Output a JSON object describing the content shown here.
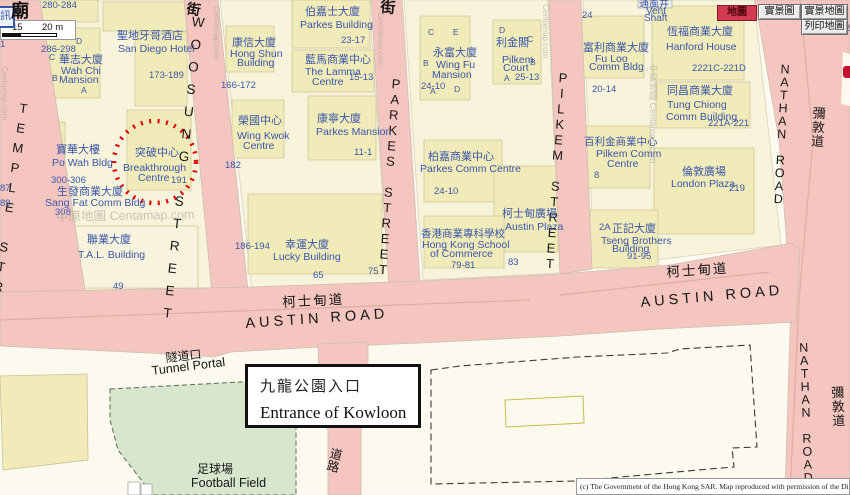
{
  "colors": {
    "road_pink": "#F4C6BF",
    "block_beige": "#F8F4DC",
    "footprint_yellow": "#F1EBBA",
    "park_green": "#D8E6CE",
    "label_blue": "#3A57A8",
    "street_black": "#161616",
    "circle_red": "#E10000",
    "selected_button_red": "#D23B52",
    "mtr_red": "#C8102E"
  },
  "toolbar": {
    "map": "地圖",
    "real_view": "實景圖",
    "real_view_map": "實景地圖",
    "print_map": "列印地圖"
  },
  "scalebar": {
    "mid_label": "15",
    "end_label": "20 m"
  },
  "corner": {
    "info_icon": "訊",
    "temple_char": "廟"
  },
  "annotation_box": {
    "title_zh": "九龍公園入口",
    "title_en": "Entrance of Kowloon"
  },
  "copyright": "(c) The Government of the Hong Kong SAR. Map reproduced with permission of the Di",
  "map": {
    "labels": [
      {
        "t": "TEMPLE STREET",
        "x": 18,
        "y": 100,
        "fs": 13,
        "k": "black",
        "v": true,
        "rot": 8,
        "ls": 5,
        "n": "street-label-temple"
      },
      {
        "t": "WOOSUNG STREET",
        "x": 192,
        "y": 14,
        "fs": 13.5,
        "k": "black",
        "v": true,
        "rot": 6,
        "ls": 7.5,
        "n": "street-label-woosung"
      },
      {
        "t": "PARKES STREET",
        "x": 390,
        "y": 76,
        "fs": 13,
        "k": "black",
        "v": true,
        "rot": 4,
        "ls": 0.5,
        "n": "street-label-parkes"
      },
      {
        "t": "PILKEM STREET",
        "x": 557,
        "y": 70,
        "fs": 13,
        "k": "black",
        "v": true,
        "rot": 4,
        "ls": 0.5,
        "n": "street-label-pilkem"
      },
      {
        "t": "NATHAN ROAD",
        "x": 779,
        "y": 62,
        "fs": 12.5,
        "k": "black",
        "v": true,
        "rot": 3,
        "ls": -1,
        "n": "street-label-nathan-north"
      },
      {
        "t": "NATHAN ROAD",
        "x": 797,
        "y": 341,
        "fs": 12.5,
        "k": "black",
        "v": true,
        "rot": -2,
        "ls": -1,
        "n": "street-label-nathan-south"
      },
      {
        "t": "彌敦道",
        "x": 812,
        "y": 106,
        "fs": 13,
        "k": "black",
        "v": true,
        "rot": 3,
        "ls": 1,
        "n": "street-label-nathan-zh-north"
      },
      {
        "t": "彌敦道",
        "x": 830,
        "y": 386,
        "fs": 13,
        "k": "black",
        "v": true,
        "rot": -2,
        "ls": 1,
        "n": "street-label-nathan-zh-south"
      },
      {
        "t": "AUSTIN ROAD",
        "x": 245,
        "y": 317,
        "fs": 14.5,
        "k": "black",
        "rot": -4,
        "ls": 4,
        "n": "street-label-austin-west"
      },
      {
        "t": "AUSTIN ROAD",
        "x": 640,
        "y": 296,
        "fs": 14.5,
        "k": "black",
        "rot": -5,
        "ls": 4,
        "n": "street-label-austin-east"
      },
      {
        "t": "柯士甸道",
        "x": 282,
        "y": 296,
        "fs": 13.5,
        "k": "black",
        "rot": -3,
        "ls": 2,
        "n": "street-label-austin-zh-west"
      },
      {
        "t": "柯士甸道",
        "x": 666,
        "y": 266,
        "fs": 13.5,
        "k": "black",
        "rot": -4,
        "ls": 2,
        "n": "street-label-austin-zh-east"
      },
      {
        "t": "道路",
        "x": 330,
        "y": 446,
        "fs": 12.5,
        "k": "black",
        "v": true,
        "rot": 14,
        "n": "street-label-road"
      },
      {
        "t": "街",
        "x": 188,
        "y": 1,
        "fs": 14,
        "k": "black",
        "rot": 10,
        "b": true,
        "n": "street-char"
      },
      {
        "t": "街",
        "x": 381,
        "y": 0,
        "fs": 15,
        "k": "black",
        "rot": 4,
        "b": true,
        "n": "street-char"
      },
      {
        "t": "隧道口",
        "x": 165,
        "y": 352,
        "fs": 12,
        "k": "black",
        "rot": -6,
        "n": "tunnel-portal-zh"
      },
      {
        "t": "Tunnel Portal",
        "x": 151,
        "y": 365,
        "fs": 12.5,
        "k": "black",
        "rot": -7,
        "n": "tunnel-portal-en"
      },
      {
        "t": "足球場",
        "x": 197,
        "y": 463,
        "fs": 12,
        "k": "black",
        "n": "football-field-zh"
      },
      {
        "t": "Football Field",
        "x": 191,
        "y": 477,
        "fs": 12.5,
        "k": "black",
        "n": "football-field-en"
      },
      {
        "t": "280-284",
        "x": 42,
        "y": 1,
        "fs": 9.5
      },
      {
        "t": "1",
        "x": 0,
        "y": 40,
        "fs": 9.5
      },
      {
        "t": "286-298",
        "x": 41,
        "y": 45,
        "fs": 9.5
      },
      {
        "t": "D",
        "x": 76,
        "y": 37,
        "fs": 8.5
      },
      {
        "t": "C",
        "x": 49,
        "y": 53,
        "fs": 8.5
      },
      {
        "t": "B",
        "x": 52,
        "y": 74,
        "fs": 8.5
      },
      {
        "t": "A",
        "x": 81,
        "y": 86,
        "fs": 8.5
      },
      {
        "t": "華志大廈",
        "x": 59,
        "y": 55,
        "fs": 11
      },
      {
        "t": "Wah Chi",
        "x": 61,
        "y": 66,
        "fs": 10.5
      },
      {
        "t": "Mansion",
        "x": 59,
        "y": 75,
        "fs": 10.5
      },
      {
        "t": "聖地牙哥酒店",
        "x": 117,
        "y": 31,
        "fs": 11
      },
      {
        "t": "San Diego Hotel",
        "x": 118,
        "y": 44,
        "fs": 10.5
      },
      {
        "t": "173-189",
        "x": 149,
        "y": 71,
        "fs": 9.5
      },
      {
        "t": "寶華大樓",
        "x": 56,
        "y": 145,
        "fs": 11
      },
      {
        "t": "Po Wah Bldg",
        "x": 52,
        "y": 158,
        "fs": 10.5
      },
      {
        "t": "300-306",
        "x": 51,
        "y": 176,
        "fs": 9.5
      },
      {
        "t": "生發商業大廈",
        "x": 57,
        "y": 187,
        "fs": 11
      },
      {
        "t": "Sang Fat Comm Bldg",
        "x": 45,
        "y": 198,
        "fs": 10.5
      },
      {
        "t": "308",
        "x": 55,
        "y": 208,
        "fs": 9.5
      },
      {
        "t": "87",
        "x": 0,
        "y": 184,
        "fs": 9.5
      },
      {
        "t": "89",
        "x": 0,
        "y": 199,
        "fs": 9.5
      },
      {
        "t": "突破中心",
        "x": 135,
        "y": 148,
        "fs": 11
      },
      {
        "t": "Breakthrough",
        "x": 123,
        "y": 163,
        "fs": 10.5
      },
      {
        "t": "Centre",
        "x": 138,
        "y": 173,
        "fs": 10.5
      },
      {
        "t": "191",
        "x": 171,
        "y": 176,
        "fs": 9.5
      },
      {
        "t": "聯業大廈",
        "x": 87,
        "y": 235,
        "fs": 11
      },
      {
        "t": "T.A.L. Building",
        "x": 78,
        "y": 250,
        "fs": 10.5
      },
      {
        "t": "49",
        "x": 113,
        "y": 282,
        "fs": 9.5
      },
      {
        "t": "康信大廈",
        "x": 232,
        "y": 38,
        "fs": 11
      },
      {
        "t": "Hong Shun",
        "x": 230,
        "y": 49,
        "fs": 10.5
      },
      {
        "t": "Building",
        "x": 237,
        "y": 58,
        "fs": 10.5
      },
      {
        "t": "166-172",
        "x": 221,
        "y": 81,
        "fs": 9.5
      },
      {
        "t": "伯嘉士大廈",
        "x": 305,
        "y": 7,
        "fs": 11
      },
      {
        "t": "Parkes Building",
        "x": 300,
        "y": 20,
        "fs": 10.5
      },
      {
        "t": "23-17",
        "x": 341,
        "y": 36,
        "fs": 9.5
      },
      {
        "t": "藍馬商業中心",
        "x": 305,
        "y": 55,
        "fs": 11
      },
      {
        "t": "The Lamma",
        "x": 305,
        "y": 67,
        "fs": 10.5
      },
      {
        "t": "Centre",
        "x": 312,
        "y": 77,
        "fs": 10.5
      },
      {
        "t": "15-13",
        "x": 349,
        "y": 73,
        "fs": 9.5
      },
      {
        "t": "榮國中心",
        "x": 238,
        "y": 116,
        "fs": 11
      },
      {
        "t": "Wing Kwok",
        "x": 237,
        "y": 131,
        "fs": 10.5
      },
      {
        "t": "Centre",
        "x": 243,
        "y": 141,
        "fs": 10.5
      },
      {
        "t": "182",
        "x": 225,
        "y": 161,
        "fs": 9.5
      },
      {
        "t": "康寧大廈",
        "x": 317,
        "y": 114,
        "fs": 11
      },
      {
        "t": "Parkes Mansion",
        "x": 316,
        "y": 127,
        "fs": 10.5
      },
      {
        "t": "11-1",
        "x": 354,
        "y": 148,
        "fs": 9.5
      },
      {
        "t": "186-194",
        "x": 235,
        "y": 242,
        "fs": 9.5
      },
      {
        "t": "幸運大廈",
        "x": 285,
        "y": 240,
        "fs": 11
      },
      {
        "t": "Lucky Building",
        "x": 273,
        "y": 252,
        "fs": 10.5
      },
      {
        "t": "65",
        "x": 313,
        "y": 271,
        "fs": 9.5
      },
      {
        "t": "75",
        "x": 368,
        "y": 267,
        "fs": 9.5
      },
      {
        "t": "C",
        "x": 428,
        "y": 28,
        "fs": 8.5
      },
      {
        "t": "E",
        "x": 453,
        "y": 28,
        "fs": 8.5
      },
      {
        "t": "B",
        "x": 423,
        "y": 59,
        "fs": 8.5
      },
      {
        "t": "A",
        "x": 430,
        "y": 87,
        "fs": 8.5
      },
      {
        "t": "D",
        "x": 454,
        "y": 85,
        "fs": 8.5
      },
      {
        "t": "永富大廈",
        "x": 433,
        "y": 48,
        "fs": 11
      },
      {
        "t": "Wing Fu",
        "x": 436,
        "y": 60,
        "fs": 10.5
      },
      {
        "t": "Mansion",
        "x": 432,
        "y": 70,
        "fs": 10.5
      },
      {
        "t": "24-10",
        "x": 421,
        "y": 82,
        "fs": 9.5
      },
      {
        "t": "D",
        "x": 499,
        "y": 26,
        "fs": 8.5
      },
      {
        "t": "C",
        "x": 527,
        "y": 35,
        "fs": 8.5
      },
      {
        "t": "B",
        "x": 530,
        "y": 58,
        "fs": 8.5
      },
      {
        "t": "A",
        "x": 504,
        "y": 74,
        "fs": 8.5
      },
      {
        "t": "利金閣",
        "x": 496,
        "y": 38,
        "fs": 11
      },
      {
        "t": "Pilkem",
        "x": 502,
        "y": 55,
        "fs": 10.5
      },
      {
        "t": "Court",
        "x": 503,
        "y": 63,
        "fs": 10.5
      },
      {
        "t": "25-13",
        "x": 515,
        "y": 73,
        "fs": 9.5
      },
      {
        "t": "柏嘉商業中心",
        "x": 428,
        "y": 152,
        "fs": 11
      },
      {
        "t": "Parkes Comm Centre",
        "x": 420,
        "y": 164,
        "fs": 10.5
      },
      {
        "t": "24-10",
        "x": 434,
        "y": 187,
        "fs": 9.5
      },
      {
        "t": "柯士甸廣場",
        "x": 502,
        "y": 209,
        "fs": 11
      },
      {
        "t": "Austin Plaza",
        "x": 505,
        "y": 222,
        "fs": 10.5
      },
      {
        "t": "香港商業專科學校",
        "x": 421,
        "y": 229,
        "fs": 10.5
      },
      {
        "t": "Hong Kong School",
        "x": 422,
        "y": 240,
        "fs": 10.5
      },
      {
        "t": "of Commerce",
        "x": 430,
        "y": 249,
        "fs": 10.5
      },
      {
        "t": "79-81",
        "x": 451,
        "y": 261,
        "fs": 9.5
      },
      {
        "t": "83",
        "x": 508,
        "y": 258,
        "fs": 9.5
      },
      {
        "t": "24",
        "x": 582,
        "y": 11,
        "fs": 9.5
      },
      {
        "t": "富利商業大廈",
        "x": 583,
        "y": 43,
        "fs": 11
      },
      {
        "t": "Fu Loo",
        "x": 595,
        "y": 54,
        "fs": 10.5
      },
      {
        "t": "Comm Bldg",
        "x": 589,
        "y": 62,
        "fs": 10.5
      },
      {
        "t": "20-14",
        "x": 592,
        "y": 85,
        "fs": 9.5
      },
      {
        "t": "通風井",
        "x": 639,
        "y": 0,
        "fs": 10
      },
      {
        "t": "Vent",
        "x": 646,
        "y": 7,
        "fs": 10
      },
      {
        "t": "Shaft",
        "x": 644,
        "y": 14,
        "fs": 10
      },
      {
        "t": "恆福商業大廈",
        "x": 667,
        "y": 27,
        "fs": 11
      },
      {
        "t": "Hanford House",
        "x": 666,
        "y": 42,
        "fs": 10.5
      },
      {
        "t": "2221C-221D",
        "x": 692,
        "y": 64,
        "fs": 9.5
      },
      {
        "t": "同昌商業大廈",
        "x": 667,
        "y": 86,
        "fs": 11
      },
      {
        "t": "Tung Chiong",
        "x": 667,
        "y": 100,
        "fs": 10.5
      },
      {
        "t": "Comm Building",
        "x": 666,
        "y": 112,
        "fs": 10.5
      },
      {
        "t": "221A-221",
        "x": 708,
        "y": 119,
        "fs": 9.5
      },
      {
        "t": "百利金商業中心",
        "x": 584,
        "y": 137,
        "fs": 10.5
      },
      {
        "t": "Pilkem Comm",
        "x": 596,
        "y": 149,
        "fs": 10.5
      },
      {
        "t": "Centre",
        "x": 607,
        "y": 159,
        "fs": 10.5
      },
      {
        "t": "8",
        "x": 594,
        "y": 171,
        "fs": 9.5
      },
      {
        "t": "倫敦廣場",
        "x": 682,
        "y": 167,
        "fs": 11
      },
      {
        "t": "London Plaza",
        "x": 671,
        "y": 179,
        "fs": 10.5
      },
      {
        "t": "219",
        "x": 729,
        "y": 184,
        "fs": 9.5
      },
      {
        "t": "2A",
        "x": 599,
        "y": 223,
        "fs": 9.5
      },
      {
        "t": "正記大廈",
        "x": 612,
        "y": 224,
        "fs": 11
      },
      {
        "t": "Tseng Brothers",
        "x": 601,
        "y": 236,
        "fs": 10.5
      },
      {
        "t": "Building",
        "x": 612,
        "y": 244,
        "fs": 10.5
      },
      {
        "t": "91-95",
        "x": 627,
        "y": 252,
        "fs": 9.5
      },
      {
        "t": "2",
        "x": 845,
        "y": 24,
        "fs": 9.5
      },
      {
        "t": "中原地圖 Centamap.com",
        "x": 56,
        "y": 211,
        "fs": 12.5,
        "k": "wm",
        "rot": -1,
        "n": "watermark"
      },
      {
        "t": "Centamap.com",
        "x": 0,
        "y": 66,
        "fs": 8,
        "k": "wm",
        "vr": true,
        "n": "watermark"
      },
      {
        "t": "Centamap.com",
        "x": 212,
        "y": 6,
        "fs": 8,
        "k": "wm",
        "vr": true,
        "n": "watermark"
      },
      {
        "t": "Centamap.com",
        "x": 376,
        "y": 12,
        "fs": 8,
        "k": "wm",
        "vr": true,
        "n": "watermark"
      },
      {
        "t": "Centamap.com",
        "x": 541,
        "y": 4,
        "fs": 8,
        "k": "wm",
        "vr": true,
        "n": "watermark"
      },
      {
        "t": "中原地圖 Centamap.com",
        "x": 648,
        "y": 64,
        "fs": 9,
        "k": "wm",
        "vr": true,
        "n": "watermark"
      }
    ]
  }
}
